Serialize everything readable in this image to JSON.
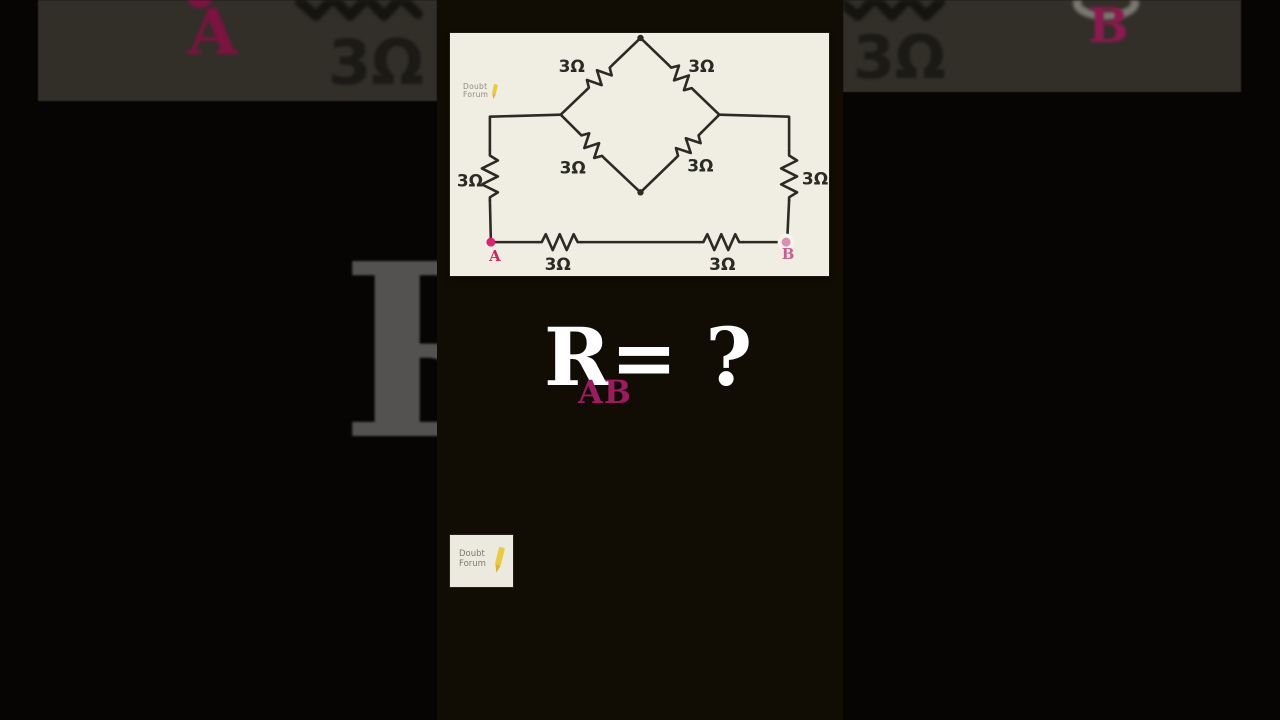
{
  "circuit": {
    "watermark": {
      "line1": "Doubt",
      "line2": "Forum"
    },
    "resistors": {
      "top_left": "3Ω",
      "top_right": "3Ω",
      "mid_left": "3Ω",
      "mid_right": "3Ω",
      "left_rail": "3Ω",
      "right_rail": "3Ω",
      "bottom_left": "3Ω",
      "bottom_right": "3Ω"
    },
    "terminals": {
      "a": "A",
      "b": "B"
    }
  },
  "question": {
    "symbol": "R",
    "subscript": "AB",
    "rest": "= ?"
  },
  "logo_card": {
    "line1": "Doubt",
    "line2": "Forum"
  },
  "background": {
    "left_band": {
      "terminal": "A",
      "resistor": "3Ω"
    },
    "right_band": {
      "terminal": "B",
      "resistor": "3Ω"
    },
    "big_letter": "R"
  },
  "colors": {
    "page_bg": "#070503",
    "video_bg": "#110d05",
    "band_bg": "#322f29",
    "card_bg": "#f0eee3",
    "ink": "#2b2b25",
    "accent_pink": "#d6246e",
    "terminal_b_faded": "#d98fb2",
    "subscript_magenta": "#9c1a60",
    "question_white": "#ffffff",
    "watermark_gray": "#8e8c7c",
    "pencil_yellow": "#e9cb42",
    "big_letter_gray": "#545250"
  }
}
